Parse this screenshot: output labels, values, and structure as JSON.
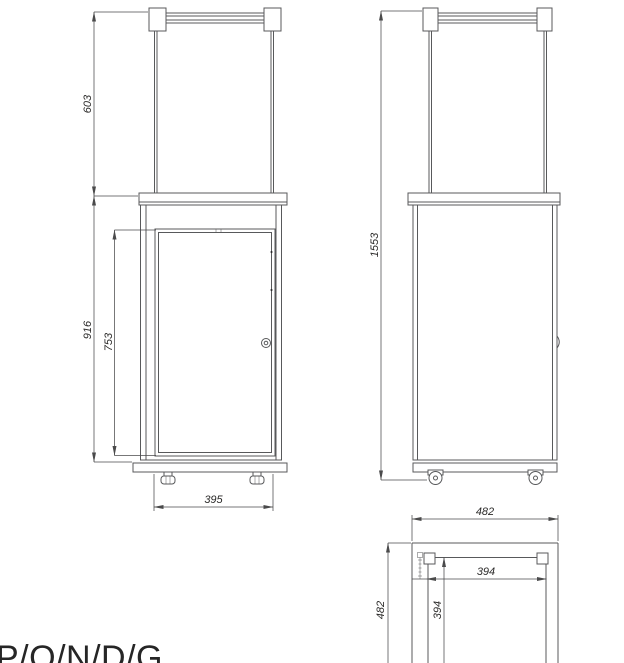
{
  "drawing": {
    "model_label": "P/O/N/D/G",
    "dimensions": {
      "front_top_section_height": "603",
      "front_cabinet_height": "916",
      "front_door_height": "753",
      "front_base_width": "395",
      "side_total_height": "1553",
      "plan_overall_width": "482",
      "plan_overall_depth": "482",
      "plan_inner_width": "394",
      "plan_inner_depth": "394"
    },
    "colors": {
      "line": "#58595b",
      "dimension": "#4a4a4b",
      "text": "#2b2a29",
      "background": "#ffffff"
    }
  }
}
